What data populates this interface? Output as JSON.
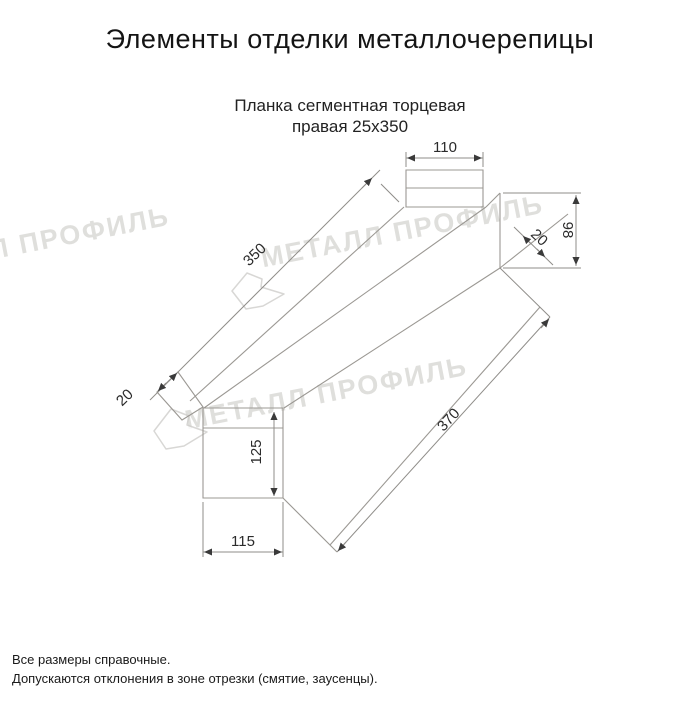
{
  "header": {
    "title": "Элементы отделки металлочерепицы"
  },
  "product": {
    "name_line1": "Планка сегментная торцевая",
    "name_line2": "правая 25x350"
  },
  "drawing": {
    "type": "technical-dimension-drawing",
    "dimensions": {
      "top_flange_width": "110",
      "strip_length": "350",
      "end_face_height": "98",
      "right_hem": "20",
      "left_hem": "20",
      "total_diagonal_length": "370",
      "front_face_height": "125",
      "bottom_width": "115"
    },
    "watermark_text": "МЕТАЛЛ ПРОФИЛЬ"
  },
  "footer": {
    "note1": "Все размеры справочные.",
    "note2": "Допускаются отклонения в зоне отрезки (смятие, заусенцы)."
  },
  "colors": {
    "background": "#ffffff",
    "line": "#9b9893",
    "dimension_line": "#8f8d89",
    "arrow": "#3a3a3a",
    "text": "#1c1c1c",
    "watermark": "#c6c5c1"
  }
}
